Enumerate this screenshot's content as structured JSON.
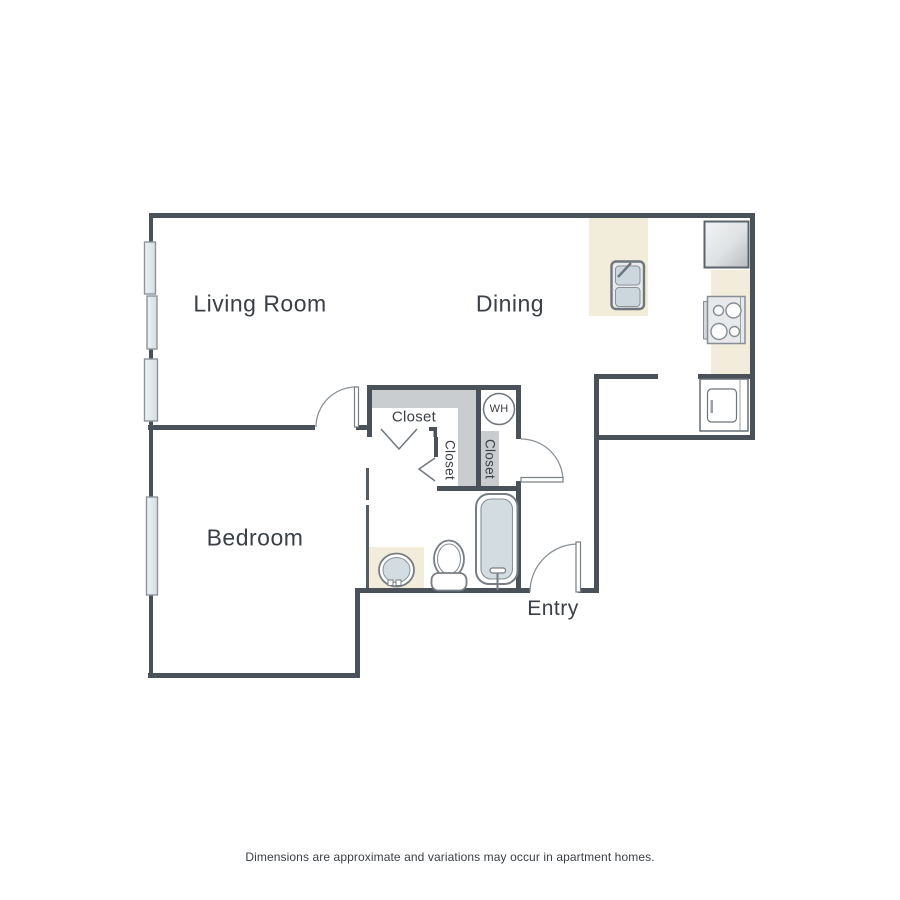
{
  "floorplan": {
    "rooms": {
      "living_room": "Living Room",
      "dining": "Dining",
      "bedroom": "Bedroom",
      "entry": "Entry"
    },
    "labels": {
      "closet_top": "Closet",
      "closet_left": "Closet",
      "closet_wh": "Closet",
      "water_heater": "WH"
    },
    "disclaimer": "Dimensions are approximate and variations may occur in apartment homes.",
    "fixtures": [
      "kitchen-island-sink",
      "refrigerator",
      "stove-cooktop",
      "washer-appliance",
      "bathroom-vanity-sink",
      "toilet",
      "bathtub",
      "water-heater",
      "window",
      "door-swing",
      "bifold-closet-door",
      "closet-shelf"
    ],
    "colors": {
      "wall": "#4a5158",
      "thin_line": "#6f767d",
      "shelf_gray": "#c9cdd0",
      "counter_cream": "#f1edda",
      "fixture_blue": "#d2dce1",
      "text": "#3b4046"
    }
  }
}
